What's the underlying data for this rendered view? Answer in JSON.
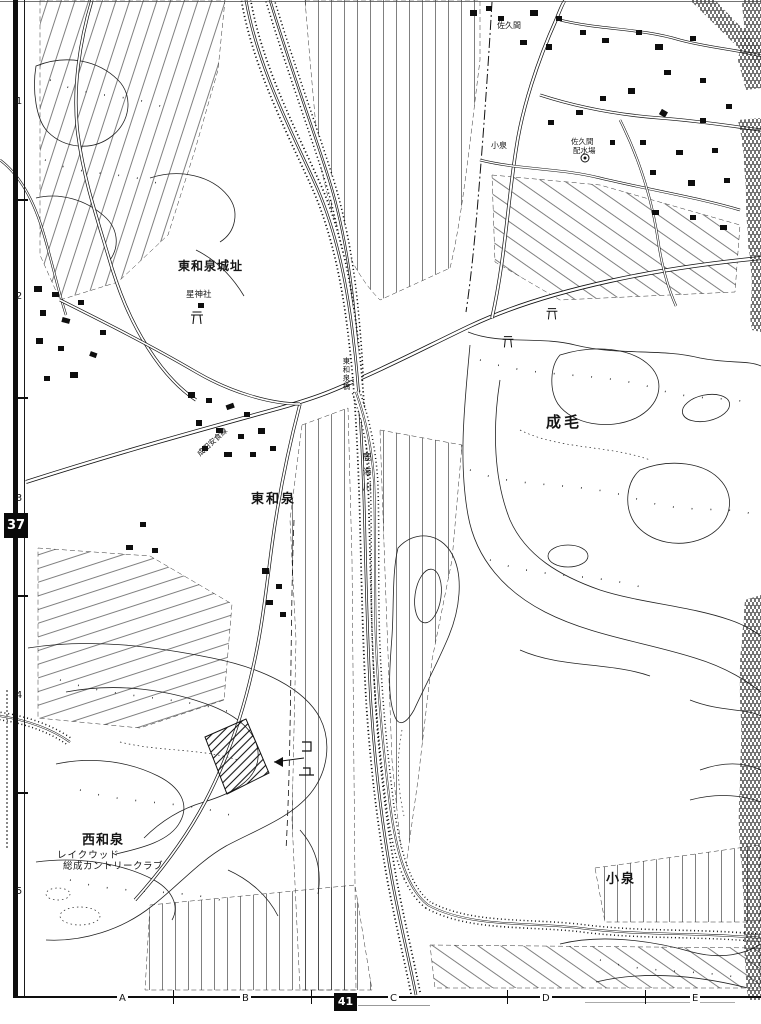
{
  "colors": {
    "ink": "#161616",
    "paper": "#ffffff",
    "badge_bg": "#0a0a0a",
    "badge_fg": "#ffffff"
  },
  "frame": {
    "rows": [
      "1",
      "2",
      "3",
      "4",
      "5"
    ],
    "cols": [
      "A",
      "B",
      "C",
      "D",
      "E"
    ],
    "row_badge": "37",
    "col_badge": "41"
  },
  "labels": {
    "castle_ruins": "東和泉城址",
    "shrine": "星神社",
    "higashi_izumi": "東和泉",
    "naruke": "成毛",
    "nishi_izumi": "西和泉",
    "lakewood1": "レイクウッド",
    "lakewood2": "総成カントリークラブ",
    "koizumi": "小泉",
    "koizumi_small": "小泉",
    "sakuma": "佐久間",
    "sakuma_sub": "配水場",
    "river": "鹿海川",
    "bridge": "東和泉橋",
    "road": "成田安食線"
  }
}
